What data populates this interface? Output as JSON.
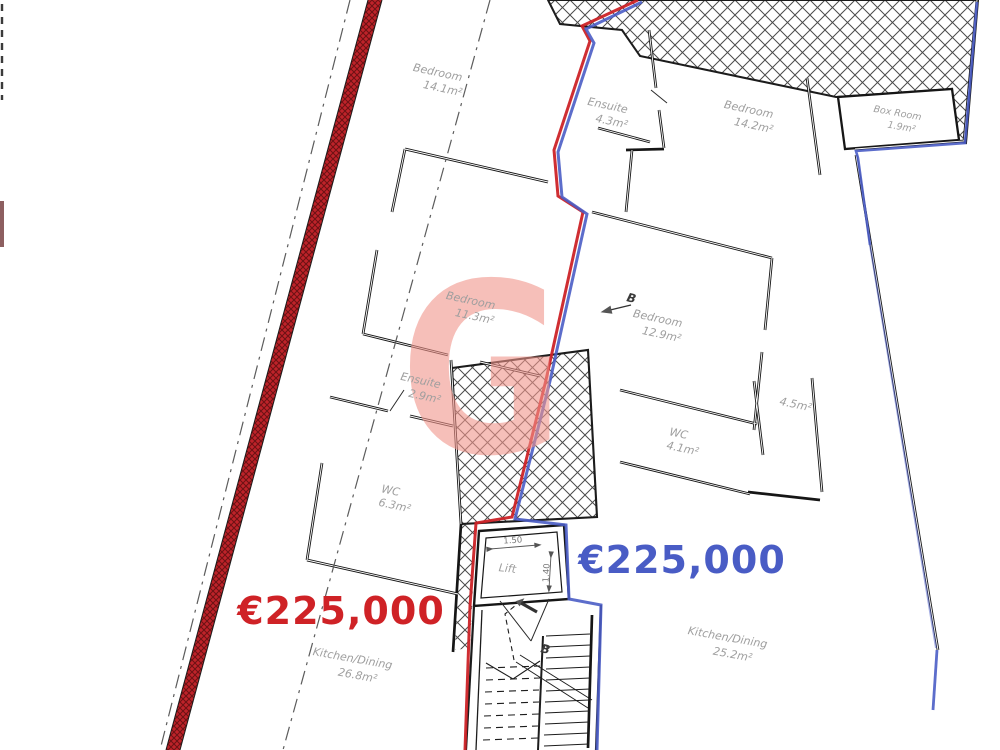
{
  "watermark": {
    "letter": "G",
    "color": "#f09488"
  },
  "units": [
    {
      "side": "left",
      "price": "€225,000",
      "color": "#cf2127"
    },
    {
      "side": "right",
      "price": "€225,000",
      "color": "#4a5cc5"
    }
  ],
  "rooms": [
    {
      "name": "Bedroom",
      "area": "14.1m²"
    },
    {
      "name": "Ensuite",
      "area": "4.3m²"
    },
    {
      "name": "Bedroom",
      "area": "14.2m²"
    },
    {
      "name": "Box Room",
      "area": "1.9m²"
    },
    {
      "name": "Bedroom",
      "area": "11.3m²"
    },
    {
      "name": "Bedroom",
      "area": "12.9m²"
    },
    {
      "name": "Ensuite",
      "area": "2.9m²"
    },
    {
      "name": "WC",
      "area": "4.1m²"
    },
    {
      "name": "",
      "area": "4.5m²"
    },
    {
      "name": "WC",
      "area": "6.3m²"
    },
    {
      "name": "Kitchen/Dining",
      "area": "26.8m²"
    },
    {
      "name": "Kitchen/Dining",
      "area": "25.2m²"
    },
    {
      "name": "Lift",
      "area": ""
    }
  ],
  "dimensions": [
    "1.50",
    "1.40"
  ],
  "markers": [
    "B",
    "B"
  ]
}
